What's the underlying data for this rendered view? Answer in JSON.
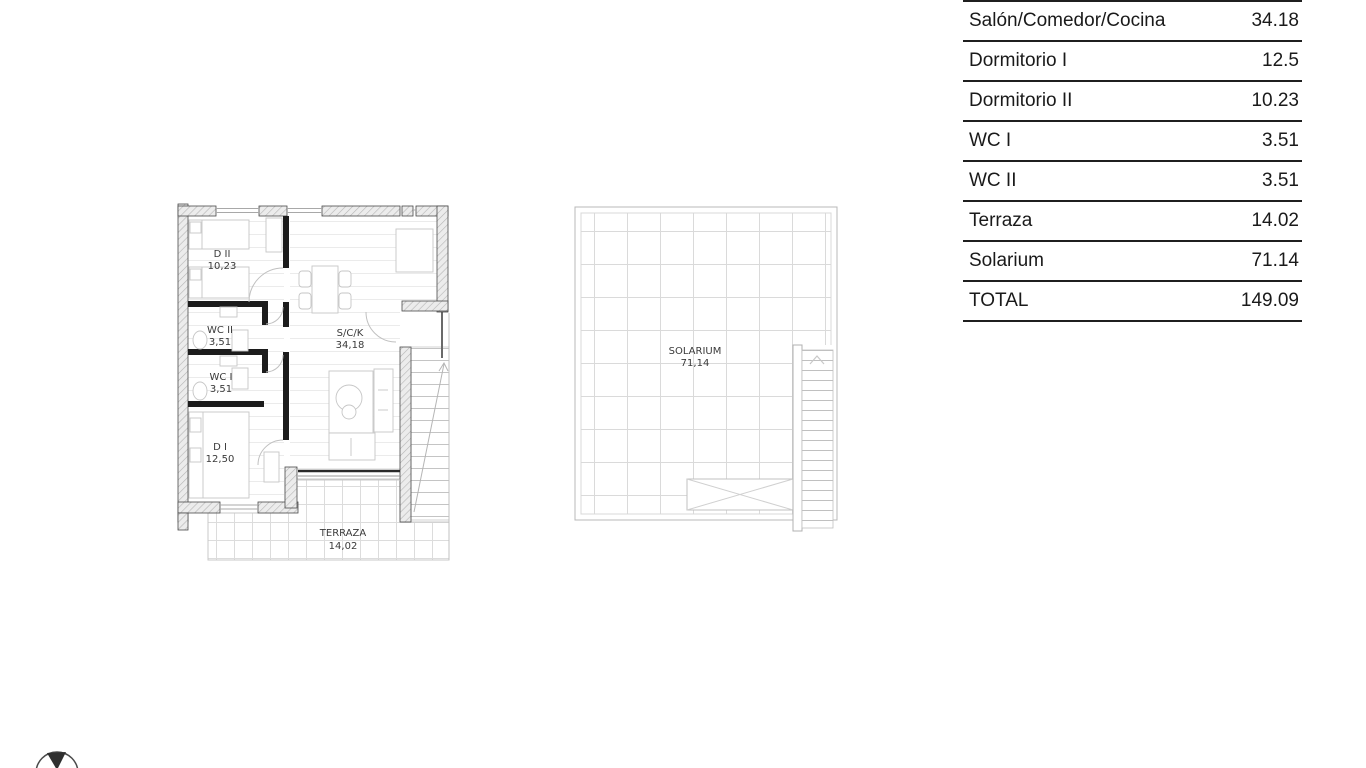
{
  "table": {
    "rows": [
      {
        "label": "Salón/Comedor/Cocina",
        "value": "34.18"
      },
      {
        "label": "Dormitorio I",
        "value": "12.5"
      },
      {
        "label": "Dormitorio II",
        "value": "10.23"
      },
      {
        "label": "WC I",
        "value": "3.51"
      },
      {
        "label": "WC II",
        "value": "3.51"
      },
      {
        "label": "Terraza",
        "value": "14.02"
      },
      {
        "label": "Solarium",
        "value": "71.14"
      },
      {
        "label": "TOTAL",
        "value": "149.09"
      }
    ]
  },
  "ground_floor": {
    "rooms": {
      "d2": {
        "name": "D II",
        "area": "10,23"
      },
      "wc2": {
        "name": "WC II",
        "area": "3,51"
      },
      "wc1": {
        "name": "WC I",
        "area": "3,51"
      },
      "d1": {
        "name": "D I",
        "area": "12,50"
      },
      "sck": {
        "name": "S/C/K",
        "area": "34,18"
      },
      "terraza": {
        "name": "TERRAZA",
        "area": "14,02"
      }
    }
  },
  "first_floor": {
    "solarium": {
      "name": "SOLARIUM",
      "area": "71,14"
    }
  },
  "colors": {
    "table_line": "#1f1f1f",
    "wall_dark": "#1c1c1c",
    "wall_hatch_bg": "#ececec",
    "thin_line": "#c6c6c6"
  }
}
